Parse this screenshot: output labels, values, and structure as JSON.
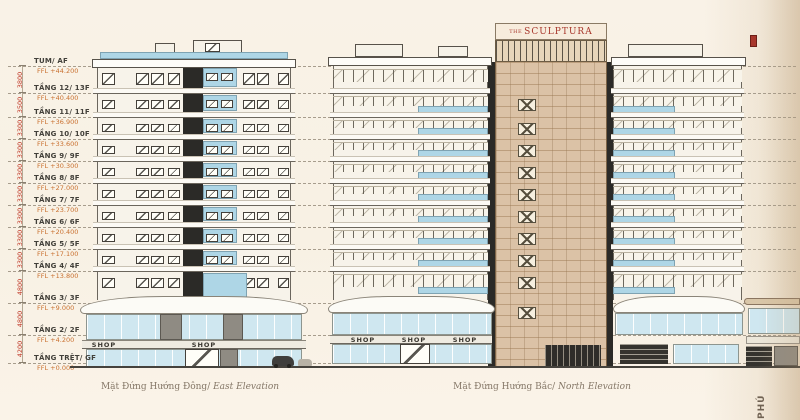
{
  "sign": {
    "the": "THE",
    "name": "SCULPTURA"
  },
  "levels": [
    {
      "name": "TUM/ AF",
      "ffl": "FFL +44.200"
    },
    {
      "name": "TẦNG 12/ 13F",
      "ffl": "FFL +40.400"
    },
    {
      "name": "TẦNG 11/ 11F",
      "ffl": "FFL +36.900"
    },
    {
      "name": "TẦNG 10/ 10F",
      "ffl": "FFL +33.600"
    },
    {
      "name": "TẦNG 9/ 9F",
      "ffl": "FFL +30.300"
    },
    {
      "name": "TẦNG 8/ 8F",
      "ffl": "FFL +27.000"
    },
    {
      "name": "TẦNG 7/ 7F",
      "ffl": "FFL +23.700"
    },
    {
      "name": "TẦNG 6/ 6F",
      "ffl": "FFL +20.400"
    },
    {
      "name": "TẦNG 5/ 5F",
      "ffl": "FFL +17.100"
    },
    {
      "name": "TẦNG 4/ 4F",
      "ffl": "FFL +13.800"
    },
    {
      "name": "TẦNG 3/ 3F",
      "ffl": "FFL +9.000"
    },
    {
      "name": "TẦNG 2/ 2F",
      "ffl": "FFL +4.200"
    },
    {
      "name": "TẦNG TRỆT/ GF",
      "ffl": "FFL +0.000"
    }
  ],
  "dimensions": [
    "3800",
    "3500",
    "3300",
    "3300",
    "3300",
    "3300",
    "3300",
    "3300",
    "3300",
    "4800",
    "4800",
    "4200"
  ],
  "elevations": {
    "east": {
      "caption_vi": "Mặt Đứng Hướng Đông/",
      "caption_en": " East Elevation",
      "shops": [
        "SHOP",
        "SHOP"
      ]
    },
    "north": {
      "caption_vi": "Mặt Đứng Hướng Bắc/",
      "caption_en": " North Elevation",
      "shops": [
        "SHOP",
        "SHOP",
        "SHOP"
      ]
    }
  },
  "side_text": "PHÚ",
  "colors": {
    "accent_red": "#a8372c",
    "ffl_orange": "#c9702f",
    "dim_red": "#c03b2a",
    "glass_blue": "#bcdcea",
    "core_tan": "#dbc2a6",
    "paper": "#f8f1e5"
  }
}
